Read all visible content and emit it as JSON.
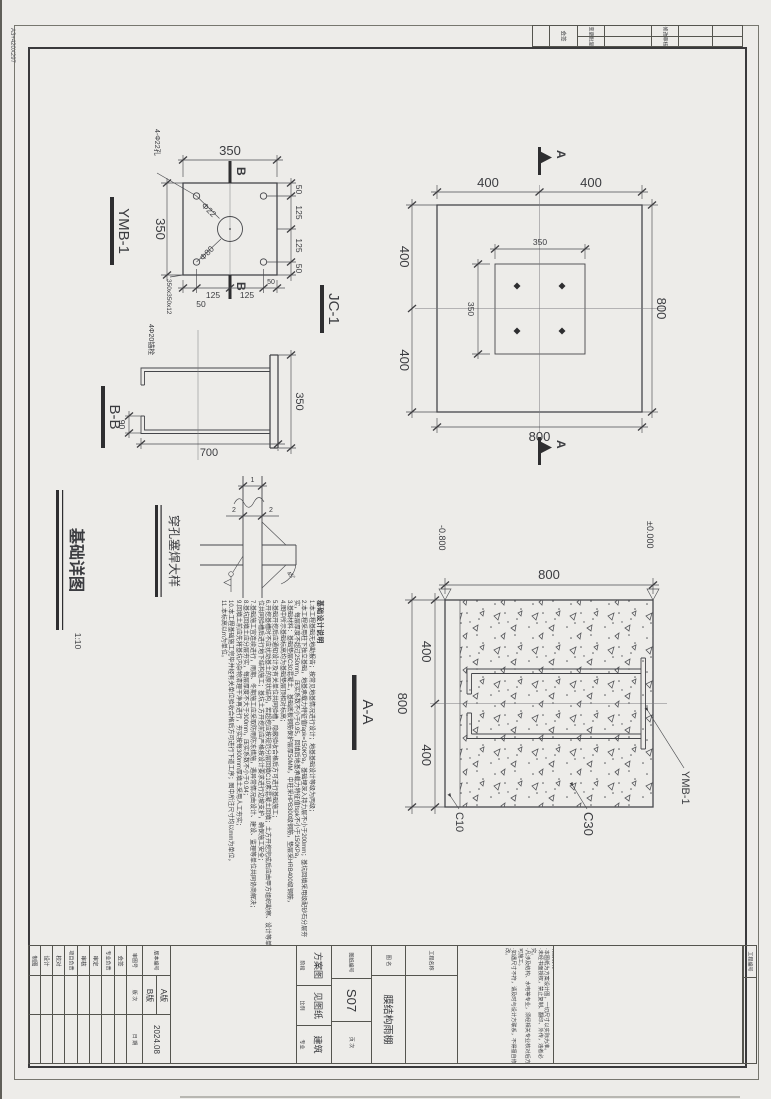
{
  "sheet": {
    "edge_label": "A3+420X297"
  },
  "sign_table": {
    "sign": "会签",
    "r1a": "变更",
    "r2a": "批复",
    "r1b": "修改",
    "r2b": "审核"
  },
  "ymb1": {
    "title": "YMB-1",
    "holes_note": "4-Φ22孔",
    "plate_note": "350x350x12",
    "dia_hole": "Φ22",
    "dia_center": "Φ80",
    "dim_top": "350",
    "dim_left": "350",
    "right_dims": [
      "50",
      "125",
      "125",
      "50"
    ],
    "bottom_dims": [
      "125",
      "125"
    ],
    "bottom_dim_left": "50",
    "bottom_dim_right": "50",
    "section": "B"
  },
  "bb": {
    "title": "B-B",
    "anchor_note": "4Φ20锚栓",
    "dim_len": "700",
    "dim_wid": "350",
    "dim_hook": "90"
  },
  "jc1": {
    "title": "JC-1",
    "section": "A",
    "top_dims": [
      "400",
      "400"
    ],
    "left_dims": [
      "400",
      "400"
    ],
    "right_dim": "800",
    "bottom_dim": "800",
    "plate_dim_h": "350",
    "plate_dim_v": "350"
  },
  "aa": {
    "title": "A-A",
    "top_dim": "800",
    "left_dims": [
      "400",
      "400"
    ],
    "left_total": "800",
    "level_left": "-0.800",
    "level_right": "±0.000",
    "c10": "C10",
    "c30": "C30",
    "plate": "YMB-1"
  },
  "foundation_title": {
    "text": "基础详图",
    "scale": "1:10"
  },
  "plugweld": {
    "title": "穿孔塞焊大样",
    "d1": "1",
    "d2a": "2",
    "d2b": "2",
    "angle": "45°"
  },
  "notes": {
    "title": "基础设计说明",
    "items": [
      "1.本工程基础无地勘报告；按常见地基情况进行设计；地基基础设计等级为丙级；",
      "2.本工程采用柱下独立基础，地基承载力特征值fapk=150KPa，基础埋深入持力层不小于200mm；基坑回填采用级配砂石分层夯实，每层厚度不超过250mm，压实系数不小于0.95，回填后地基承载力特征值fspk不小于150KPa，",
      "3.基础材料：基础垫层C30混凝土，基础底板钢筋保护层厚50MM，中柱采HPB300级钢筋，垫层采HRB400级钢筋，",
      "4.图中所示基础标高均为基础垫层顶相对标高；",
      "5.基础开挖后应通知设计及有关单位共同验槽，隐蔽验收合格后方可进行基础施工；",
      "6.开挖基槽时不应扰动基土的原状结构，若超挖应按规范分层回填C10素混凝土回填；土方开挖完成后应由甲方组织勘察、设计等单位共同验槽后进行地下结构施工；基坑土方开挖前应严格按设计要求进行边坡支护，确保施工安全；",
      "7.基础施工宜连续进行，雨期、冬期施工应采取防雨防冻措施，遇异常情况由设计、建设、监理等单位共同协商解决；",
      "8.基坑回填土应分层夯实，每层厚度不大于300mm，压实系数不小于0.94；",
      "9.回填土前应先将基坑内杂物清理干净再进行，夯实按每300mm厚填土采用人工夯实；",
      "10.本工程基础施工完毕并经有关单位验收合格后方可进行下道工序；图中所注尺寸均以mm为单位，",
      "11.本标高以m为单位。"
    ]
  },
  "titleblock": {
    "cols": [
      "制图",
      "设计",
      "校对",
      "项目负责",
      "审核",
      "审定",
      "专业负责",
      "会签"
    ],
    "review_no_label": "审图号",
    "rev_label": "版 次",
    "date_label": "日 期",
    "version_label": "版本编号",
    "rev_a": "A版",
    "rev_b": "B版",
    "date": "2024.08",
    "stage_label": "阶段",
    "stage": "方案图",
    "scale_label": "比例",
    "scale": "见图纸",
    "disc_label": "专业",
    "disc": "建筑",
    "dwgno_label": "图纸编号",
    "dwgno": "S07",
    "page_label": "页 次",
    "name_label": "图 名",
    "name": "膜结构雨棚",
    "project_label": "工程名称",
    "special_title": "特别说明：",
    "special": [
      "·本图纸为方案设计图，一切尺寸以实际为准。",
      "·未经书面授权，禁止复制、翻印、外传，违者必究。",
      "·凡涉及结构、水电等专业，须经相关专业核对后方可施工。",
      "·如遇尺寸不符，请及时与设计方联系，不得擅自修改。"
    ],
    "project_no_label": "工程编号"
  }
}
